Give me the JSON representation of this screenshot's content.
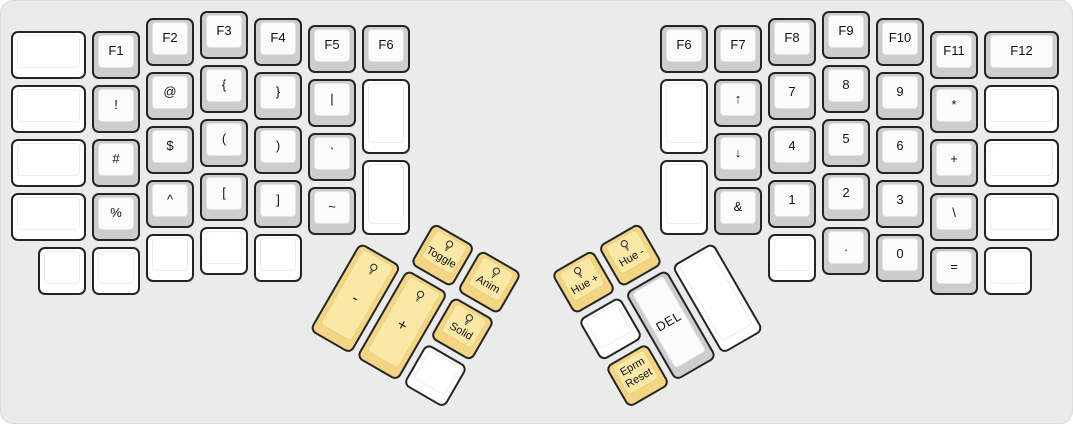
{
  "board": {
    "unit_px": 54,
    "canvas": {
      "width": 1073,
      "height": 424,
      "background": "#ebebeb"
    },
    "colors": {
      "board_bg": "#ebebeb",
      "outline": "#242424",
      "gray_key_base": "#cdcdcd",
      "gray_key_top": "#fbfbfb",
      "blank_key_base": "#ffffff",
      "blank_key_top": "#ffffff",
      "rgb_key_base": "#f4d584",
      "rgb_key_top": "#fae8a6",
      "label": "#111111"
    },
    "halves": {
      "left": {
        "origin_x": 8,
        "origin_y": 8,
        "keys": [
          {
            "name": "blank",
            "labels": [],
            "x": 0,
            "y": 0.375,
            "w": 1.5,
            "h": 1,
            "style": "white"
          },
          {
            "name": "f1",
            "labels": [
              "F1"
            ],
            "x": 1.5,
            "y": 0.375,
            "w": 1,
            "h": 1,
            "style": "gray"
          },
          {
            "name": "f2",
            "labels": [
              "F2"
            ],
            "x": 2.5,
            "y": 0.125,
            "w": 1,
            "h": 1,
            "style": "gray"
          },
          {
            "name": "f3",
            "labels": [
              "F3"
            ],
            "x": 3.5,
            "y": 0,
            "w": 1,
            "h": 1,
            "style": "gray"
          },
          {
            "name": "f4",
            "labels": [
              "F4"
            ],
            "x": 4.5,
            "y": 0.125,
            "w": 1,
            "h": 1,
            "style": "gray"
          },
          {
            "name": "f5",
            "labels": [
              "F5"
            ],
            "x": 5.5,
            "y": 0.25,
            "w": 1,
            "h": 1,
            "style": "gray"
          },
          {
            "name": "f6-left",
            "labels": [
              "F6"
            ],
            "x": 6.5,
            "y": 0.25,
            "w": 1,
            "h": 1,
            "style": "gray"
          },
          {
            "name": "blank",
            "labels": [],
            "x": 0,
            "y": 1.375,
            "w": 1.5,
            "h": 1,
            "style": "white"
          },
          {
            "name": "exclamation",
            "labels": [
              "!"
            ],
            "x": 1.5,
            "y": 1.375,
            "w": 1,
            "h": 1,
            "style": "gray"
          },
          {
            "name": "at",
            "labels": [
              "@"
            ],
            "x": 2.5,
            "y": 1.125,
            "w": 1,
            "h": 1,
            "style": "gray"
          },
          {
            "name": "open-brace",
            "labels": [
              "{"
            ],
            "x": 3.5,
            "y": 1,
            "w": 1,
            "h": 1,
            "style": "gray"
          },
          {
            "name": "close-brace",
            "labels": [
              "}"
            ],
            "x": 4.5,
            "y": 1.125,
            "w": 1,
            "h": 1,
            "style": "gray"
          },
          {
            "name": "pipe",
            "labels": [
              "|"
            ],
            "x": 5.5,
            "y": 1.25,
            "w": 1,
            "h": 1,
            "style": "gray"
          },
          {
            "name": "blank",
            "labels": [],
            "x": 6.5,
            "y": 1.25,
            "w": 1,
            "h": 1.5,
            "style": "white"
          },
          {
            "name": "blank",
            "labels": [],
            "x": 0,
            "y": 2.375,
            "w": 1.5,
            "h": 1,
            "style": "white"
          },
          {
            "name": "hash",
            "labels": [
              "#"
            ],
            "x": 1.5,
            "y": 2.375,
            "w": 1,
            "h": 1,
            "style": "gray"
          },
          {
            "name": "dollar",
            "labels": [
              "$"
            ],
            "x": 2.5,
            "y": 2.125,
            "w": 1,
            "h": 1,
            "style": "gray"
          },
          {
            "name": "open-paren",
            "labels": [
              "("
            ],
            "x": 3.5,
            "y": 2,
            "w": 1,
            "h": 1,
            "style": "gray"
          },
          {
            "name": "close-paren",
            "labels": [
              ")"
            ],
            "x": 4.5,
            "y": 2.125,
            "w": 1,
            "h": 1,
            "style": "gray"
          },
          {
            "name": "backtick",
            "labels": [
              "`"
            ],
            "x": 5.5,
            "y": 2.25,
            "w": 1,
            "h": 1,
            "style": "gray"
          },
          {
            "name": "blank",
            "labels": [],
            "x": 6.5,
            "y": 2.75,
            "w": 1,
            "h": 1.5,
            "style": "white"
          },
          {
            "name": "blank",
            "labels": [],
            "x": 0,
            "y": 3.375,
            "w": 1.5,
            "h": 1,
            "style": "white"
          },
          {
            "name": "percent",
            "labels": [
              "%"
            ],
            "x": 1.5,
            "y": 3.375,
            "w": 1,
            "h": 1,
            "style": "gray"
          },
          {
            "name": "caret",
            "labels": [
              "^"
            ],
            "x": 2.5,
            "y": 3.125,
            "w": 1,
            "h": 1,
            "style": "gray"
          },
          {
            "name": "open-bracket",
            "labels": [
              "["
            ],
            "x": 3.5,
            "y": 3,
            "w": 1,
            "h": 1,
            "style": "gray"
          },
          {
            "name": "close-bracket",
            "labels": [
              "]"
            ],
            "x": 4.5,
            "y": 3.125,
            "w": 1,
            "h": 1,
            "style": "gray"
          },
          {
            "name": "tilde",
            "labels": [
              "~"
            ],
            "x": 5.5,
            "y": 3.25,
            "w": 1,
            "h": 1,
            "style": "gray"
          },
          {
            "name": "blank",
            "labels": [],
            "x": 0.5,
            "y": 4.375,
            "w": 1,
            "h": 1,
            "style": "white"
          },
          {
            "name": "blank",
            "labels": [],
            "x": 1.5,
            "y": 4.375,
            "w": 1,
            "h": 1,
            "style": "white"
          },
          {
            "name": "blank",
            "labels": [],
            "x": 2.5,
            "y": 4.125,
            "w": 1,
            "h": 1,
            "style": "white"
          },
          {
            "name": "blank",
            "labels": [],
            "x": 3.5,
            "y": 4,
            "w": 1,
            "h": 1,
            "style": "white"
          },
          {
            "name": "blank",
            "labels": [],
            "x": 4.5,
            "y": 4.125,
            "w": 1,
            "h": 1,
            "style": "white"
          }
        ]
      },
      "right": {
        "origin_x": 657,
        "origin_y": 8,
        "keys": [
          {
            "name": "f6-right",
            "labels": [
              "F6"
            ],
            "x": 0,
            "y": 0.25,
            "w": 1,
            "h": 1,
            "style": "gray"
          },
          {
            "name": "f7",
            "labels": [
              "F7"
            ],
            "x": 1,
            "y": 0.25,
            "w": 1,
            "h": 1,
            "style": "gray"
          },
          {
            "name": "f8",
            "labels": [
              "F8"
            ],
            "x": 2,
            "y": 0.125,
            "w": 1,
            "h": 1,
            "style": "gray"
          },
          {
            "name": "f9",
            "labels": [
              "F9"
            ],
            "x": 3,
            "y": 0,
            "w": 1,
            "h": 1,
            "style": "gray"
          },
          {
            "name": "f10",
            "labels": [
              "F10"
            ],
            "x": 4,
            "y": 0.125,
            "w": 1,
            "h": 1,
            "style": "gray"
          },
          {
            "name": "f11",
            "labels": [
              "F11"
            ],
            "x": 5,
            "y": 0.375,
            "w": 1,
            "h": 1,
            "style": "gray"
          },
          {
            "name": "f12",
            "labels": [
              "F12"
            ],
            "x": 6,
            "y": 0.375,
            "w": 1.5,
            "h": 1,
            "style": "gray"
          },
          {
            "name": "blank",
            "labels": [],
            "x": 0,
            "y": 1.25,
            "w": 1,
            "h": 1.5,
            "style": "white"
          },
          {
            "name": "arrow-up",
            "labels": [
              "↑"
            ],
            "x": 1,
            "y": 1.25,
            "w": 1,
            "h": 1,
            "style": "gray"
          },
          {
            "name": "numpad-7",
            "labels": [
              "7"
            ],
            "x": 2,
            "y": 1.125,
            "w": 1,
            "h": 1,
            "style": "gray"
          },
          {
            "name": "numpad-8",
            "labels": [
              "8"
            ],
            "x": 3,
            "y": 1,
            "w": 1,
            "h": 1,
            "style": "gray"
          },
          {
            "name": "numpad-9",
            "labels": [
              "9"
            ],
            "x": 4,
            "y": 1.125,
            "w": 1,
            "h": 1,
            "style": "gray"
          },
          {
            "name": "asterisk",
            "labels": [
              "*"
            ],
            "x": 5,
            "y": 1.375,
            "w": 1,
            "h": 1,
            "style": "gray"
          },
          {
            "name": "blank",
            "labels": [],
            "x": 6,
            "y": 1.375,
            "w": 1.5,
            "h": 1,
            "style": "white"
          },
          {
            "name": "blank",
            "labels": [],
            "x": 0,
            "y": 2.75,
            "w": 1,
            "h": 1.5,
            "style": "white"
          },
          {
            "name": "arrow-down",
            "labels": [
              "↓"
            ],
            "x": 1,
            "y": 2.25,
            "w": 1,
            "h": 1,
            "style": "gray"
          },
          {
            "name": "numpad-4",
            "labels": [
              "4"
            ],
            "x": 2,
            "y": 2.125,
            "w": 1,
            "h": 1,
            "style": "gray"
          },
          {
            "name": "numpad-5",
            "labels": [
              "5"
            ],
            "x": 3,
            "y": 2,
            "w": 1,
            "h": 1,
            "style": "gray"
          },
          {
            "name": "numpad-6",
            "labels": [
              "6"
            ],
            "x": 4,
            "y": 2.125,
            "w": 1,
            "h": 1,
            "style": "gray"
          },
          {
            "name": "plus",
            "labels": [
              "+"
            ],
            "x": 5,
            "y": 2.375,
            "w": 1,
            "h": 1,
            "style": "gray"
          },
          {
            "name": "blank",
            "labels": [],
            "x": 6,
            "y": 2.375,
            "w": 1.5,
            "h": 1,
            "style": "white"
          },
          {
            "name": "ampersand",
            "labels": [
              "&"
            ],
            "x": 1,
            "y": 3.25,
            "w": 1,
            "h": 1,
            "style": "gray"
          },
          {
            "name": "numpad-1",
            "labels": [
              "1"
            ],
            "x": 2,
            "y": 3.125,
            "w": 1,
            "h": 1,
            "style": "gray"
          },
          {
            "name": "numpad-2",
            "labels": [
              "2"
            ],
            "x": 3,
            "y": 3,
            "w": 1,
            "h": 1,
            "style": "gray"
          },
          {
            "name": "numpad-3",
            "labels": [
              "3"
            ],
            "x": 4,
            "y": 3.125,
            "w": 1,
            "h": 1,
            "style": "gray"
          },
          {
            "name": "backslash",
            "labels": [
              "\\"
            ],
            "x": 5,
            "y": 3.375,
            "w": 1,
            "h": 1,
            "style": "gray"
          },
          {
            "name": "blank",
            "labels": [],
            "x": 6,
            "y": 3.375,
            "w": 1.5,
            "h": 1,
            "style": "white"
          },
          {
            "name": "blank",
            "labels": [],
            "x": 2,
            "y": 4.125,
            "w": 1,
            "h": 1,
            "style": "white"
          },
          {
            "name": "dot",
            "labels": [
              "."
            ],
            "x": 3,
            "y": 4,
            "w": 1,
            "h": 1,
            "style": "gray"
          },
          {
            "name": "numpad-0",
            "labels": [
              "0"
            ],
            "x": 4,
            "y": 4.125,
            "w": 1,
            "h": 1,
            "style": "gray"
          },
          {
            "name": "equals",
            "labels": [
              "="
            ],
            "x": 5,
            "y": 4.375,
            "w": 1,
            "h": 1,
            "style": "gray"
          },
          {
            "name": "blank",
            "labels": [],
            "x": 6,
            "y": 4.375,
            "w": 1,
            "h": 1,
            "style": "white"
          }
        ]
      },
      "left_thumb": {
        "pivot_x": 359,
        "pivot_y": 237.5,
        "rotation_deg": 30,
        "keys": [
          {
            "name": "rgb-toggle",
            "labels": [
              "Toggle"
            ],
            "x": 1,
            "y": -1,
            "w": 1,
            "h": 1,
            "style": "rgb",
            "icon": "lightbulb"
          },
          {
            "name": "rgb-anim",
            "labels": [
              "Anim"
            ],
            "x": 2,
            "y": -1,
            "w": 1,
            "h": 1,
            "style": "rgb",
            "icon": "lightbulb"
          },
          {
            "name": "brightness-down",
            "labels": [
              "-"
            ],
            "x": 0,
            "y": 0,
            "w": 1,
            "h": 2,
            "style": "rgb",
            "icon": "lightbulb",
            "big": true
          },
          {
            "name": "brightness-up",
            "labels": [
              "+"
            ],
            "x": 1,
            "y": 0,
            "w": 1,
            "h": 2,
            "style": "rgb",
            "icon": "lightbulb",
            "big": true
          },
          {
            "name": "rgb-solid",
            "labels": [
              "Solid"
            ],
            "x": 2,
            "y": 0,
            "w": 1,
            "h": 1,
            "style": "rgb",
            "icon": "lightbulb"
          },
          {
            "name": "blank",
            "labels": [],
            "x": 2,
            "y": 1,
            "w": 1,
            "h": 1,
            "style": "white"
          }
        ]
      },
      "right_thumb": {
        "pivot_x": 714,
        "pivot_y": 237.5,
        "rotation_deg": -30,
        "keys": [
          {
            "name": "hue-up",
            "labels": [
              "Hue +"
            ],
            "x": -3,
            "y": -1,
            "w": 1,
            "h": 1,
            "style": "rgb",
            "icon": "lightbulb"
          },
          {
            "name": "hue-down",
            "labels": [
              "Hue -"
            ],
            "x": -2,
            "y": -1,
            "w": 1,
            "h": 1,
            "style": "rgb",
            "icon": "lightbulb"
          },
          {
            "name": "blank",
            "labels": [],
            "x": -3,
            "y": 0,
            "w": 1,
            "h": 1,
            "style": "white"
          },
          {
            "name": "del",
            "labels": [
              "DEL"
            ],
            "x": -2,
            "y": 0,
            "w": 1,
            "h": 2,
            "style": "gray"
          },
          {
            "name": "blank",
            "labels": [],
            "x": -1,
            "y": 0,
            "w": 1,
            "h": 2,
            "style": "white"
          },
          {
            "name": "eprm-reset",
            "labels": [
              "Eprm",
              "Reset"
            ],
            "x": -3,
            "y": 1,
            "w": 1,
            "h": 1,
            "style": "rgb"
          }
        ]
      }
    }
  }
}
